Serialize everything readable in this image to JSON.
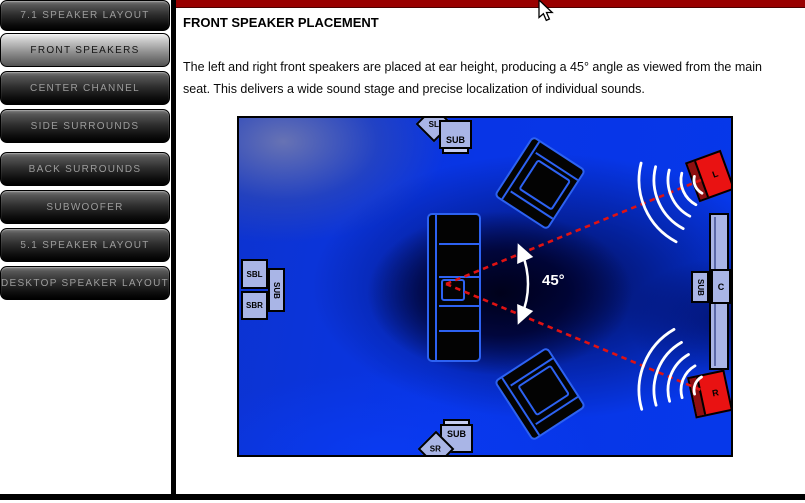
{
  "sidebar": {
    "items": [
      {
        "label": "7.1 SPEAKER LAYOUT",
        "active": false
      },
      {
        "label": "FRONT SPEAKERS",
        "active": true
      },
      {
        "label": "CENTER CHANNEL",
        "active": false
      },
      {
        "label": "SIDE SURROUNDS",
        "active": false
      },
      {
        "label": "BACK SURROUNDS",
        "active": false
      },
      {
        "label": "SUBWOOFER",
        "active": false
      },
      {
        "label": "5.1 SPEAKER LAYOUT",
        "active": false
      },
      {
        "label": "DESKTOP SPEAKER LAYOUT",
        "active": false
      }
    ]
  },
  "content": {
    "title": "FRONT SPEAKER PLACEMENT",
    "body": "The left and right front speakers are placed at ear height, producing a 45° angle as viewed from the main seat. This delivers a wide sound stage and precise localization of individual sounds."
  },
  "diagram": {
    "angle_label": "45°",
    "labels": {
      "surround_left": "SL",
      "surround_right": "SR",
      "surround_back_left": "SBL",
      "surround_back_right": "SBR",
      "center_channel": "C",
      "front_left": "L",
      "front_right": "R",
      "sub_top": "SUB",
      "sub_bottom": "SUB",
      "sub_left": "SUB",
      "sub_right": "SUB"
    }
  },
  "colors": {
    "top_bar_red": "#990000",
    "room_blue": "#0835e0",
    "speaker_box_blue": "#a9b5e6",
    "front_speaker_red": "#e91212",
    "aim_line_red": "#e01212",
    "couch_outline_blue": "#2d62f2"
  }
}
